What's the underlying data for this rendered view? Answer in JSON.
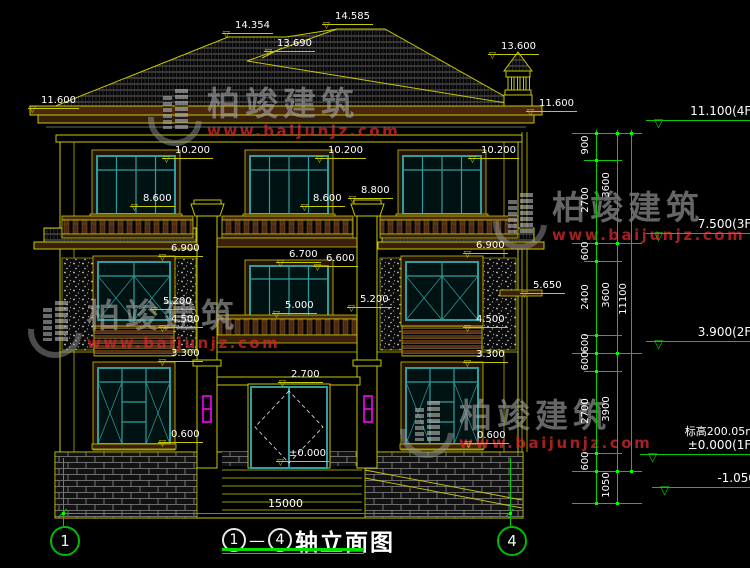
{
  "watermark": {
    "brand": "柏竣建筑",
    "url": "www.baijunjz.com"
  },
  "drawing_title": {
    "axis_start": "1",
    "separator": "—",
    "axis_end": "4",
    "name": "轴立面图"
  },
  "axis_bubbles": {
    "left": "1",
    "right": "4"
  },
  "overall_dimension": "15000",
  "facade_labels": [
    "14.354",
    "14.585",
    "13.690",
    "13.600",
    "11.600",
    "11.600",
    "10.200",
    "10.200",
    "10.200",
    "8.600",
    "8.600",
    "8.800",
    "6.900",
    "6.900",
    "6.700",
    "6.600",
    "5.650",
    "5.200",
    "5.000",
    "5.200",
    "4.500",
    "4.500",
    "3.300",
    "3.300",
    "2.700",
    "0.600",
    "0.600",
    "±0.000"
  ],
  "level_markers": [
    {
      "value": "11.100(4F)"
    },
    {
      "value": "7.500(3F)"
    },
    {
      "value": "3.900(2F)"
    },
    {
      "note": "标高200.05m",
      "value": "±0.000(1F)"
    },
    {
      "value": "-1.050"
    }
  ],
  "dimension_chains": {
    "inner": [
      "900",
      "2700",
      "600",
      "2400",
      "600",
      "600",
      "2700",
      "600"
    ],
    "middle": [
      "3600",
      "3600",
      "3900",
      "1050"
    ],
    "outer": [
      "11100"
    ]
  },
  "colors": {
    "background": "#000000",
    "line": "#c8c800",
    "dimension": "#00cc00",
    "window_frame": "#2e9e9e",
    "accent": "#ff00ff",
    "text": "#ffffff",
    "watermark_red": "#cd2828"
  }
}
